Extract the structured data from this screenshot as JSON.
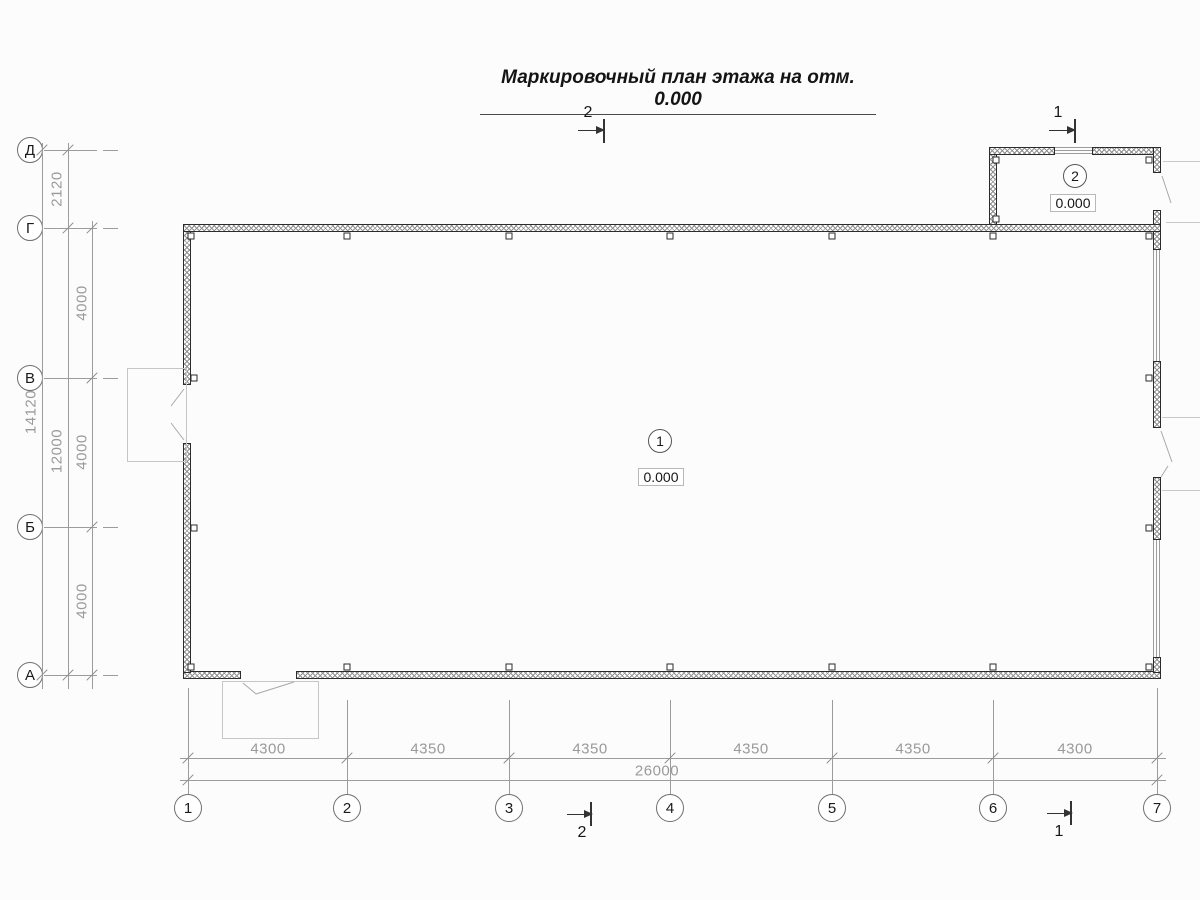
{
  "title": "Маркировочный план этажа на отм. 0.000",
  "grid": {
    "row_axes": [
      {
        "label": "Д"
      },
      {
        "label": "Г"
      },
      {
        "label": "В"
      },
      {
        "label": "Б"
      },
      {
        "label": "А"
      }
    ],
    "col_axes": [
      {
        "label": "1"
      },
      {
        "label": "2"
      },
      {
        "label": "3"
      },
      {
        "label": "4"
      },
      {
        "label": "5"
      },
      {
        "label": "6"
      },
      {
        "label": "7"
      }
    ]
  },
  "dimensions": {
    "vertical": {
      "annex_depth": "2120",
      "bays": [
        {
          "value": "4000"
        },
        {
          "value": "4000"
        },
        {
          "value": "4000"
        }
      ],
      "subtotal": "12000",
      "total": "14120"
    },
    "horizontal": {
      "bays": [
        {
          "value": "4300"
        },
        {
          "value": "4350"
        },
        {
          "value": "4350"
        },
        {
          "value": "4350"
        },
        {
          "value": "4350"
        },
        {
          "value": "4300"
        }
      ],
      "total": "26000"
    }
  },
  "rooms": [
    {
      "number": "1",
      "elevation": "0.000"
    },
    {
      "number": "2",
      "elevation": "0.000"
    }
  ],
  "section_marks": {
    "top_left": "2",
    "top_right": "1",
    "bottom_left": "2",
    "bottom_right": "1"
  },
  "colors": {
    "wall_line": "#2b2b2b",
    "grid_line": "#9c9c9c",
    "dim_text": "#9a9a9a",
    "light_line": "#c9c9c9"
  }
}
